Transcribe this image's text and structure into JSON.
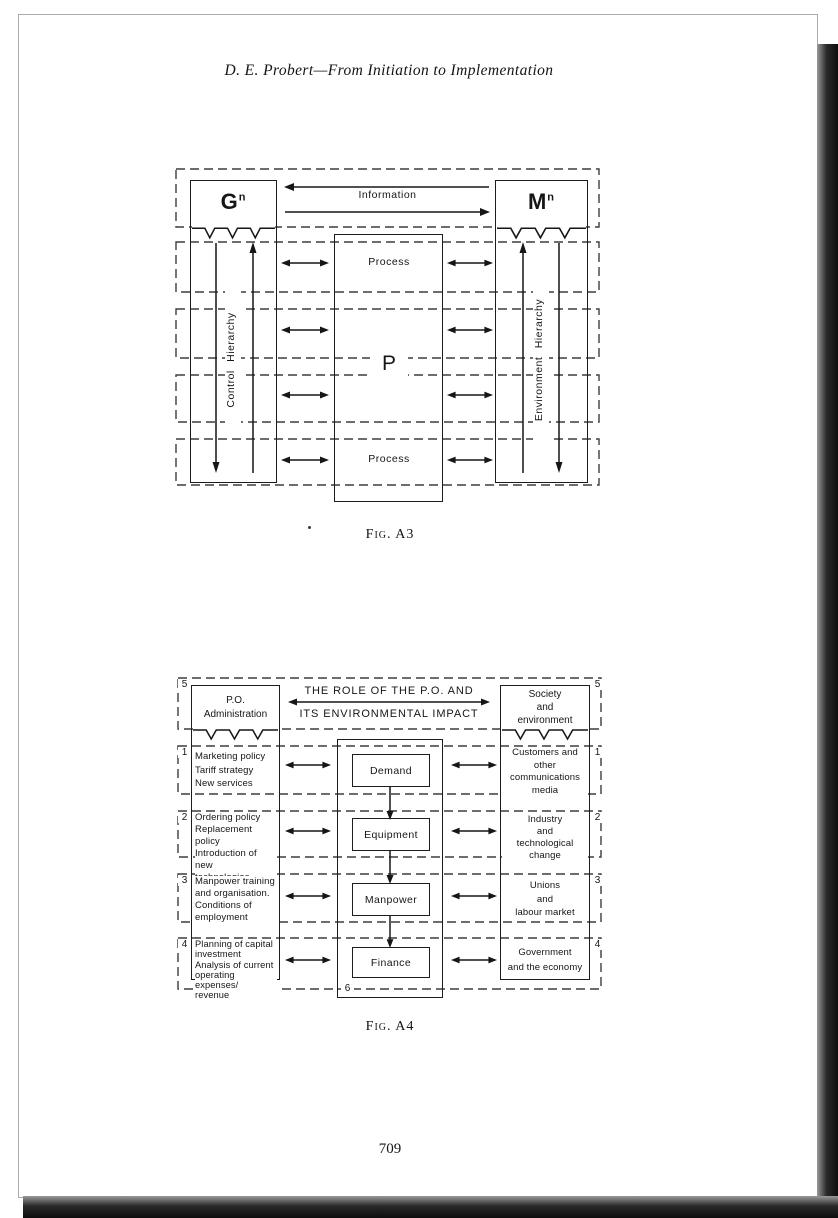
{
  "page": {
    "header": "D. E. Probert—From Initiation to Implementation",
    "page_number": "709"
  },
  "fig_a3": {
    "caption": "Fig. A3",
    "information_label": "Information",
    "left_node": {
      "letter": "G",
      "superscript": "n"
    },
    "right_node": {
      "letter": "M",
      "superscript": "n"
    },
    "left_axis": "Control Hierarchy",
    "right_axis": "Environment Hierarchy",
    "process_top": "Process",
    "center_label": "P",
    "process_bottom": "Process"
  },
  "fig_a4": {
    "caption": "Fig. A4",
    "title_line1": "THE ROLE OF THE P.O. AND",
    "title_line2": "ITS ENVIRONMENTAL IMPACT",
    "outer_number": "5",
    "center_number": "6",
    "left_header": "P.O.\nAdministration",
    "right_header": "Society\nand\nenvironment",
    "rows": [
      {
        "number": "1",
        "left": "Marketing policy\nTariff strategy\nNew services",
        "center": "Demand",
        "right": "Customers and\nother\ncommunications\nmedia"
      },
      {
        "number": "2",
        "left": "Ordering policy\nReplacement policy\nIntroduction of new\ntechnologies",
        "center": "Equipment",
        "right": "Industry\nand\ntechnological\nchange"
      },
      {
        "number": "3",
        "left": "Manpower training\nand organisation.\nConditions of\nemployment",
        "center": "Manpower",
        "right": "Unions\nand\nlabour market"
      },
      {
        "number": "4",
        "left": "Planning of capital\ninvestment\nAnalysis of current\noperating expenses/\nrevenue",
        "center": "Finance",
        "right": "Government\nand the economy"
      }
    ]
  }
}
